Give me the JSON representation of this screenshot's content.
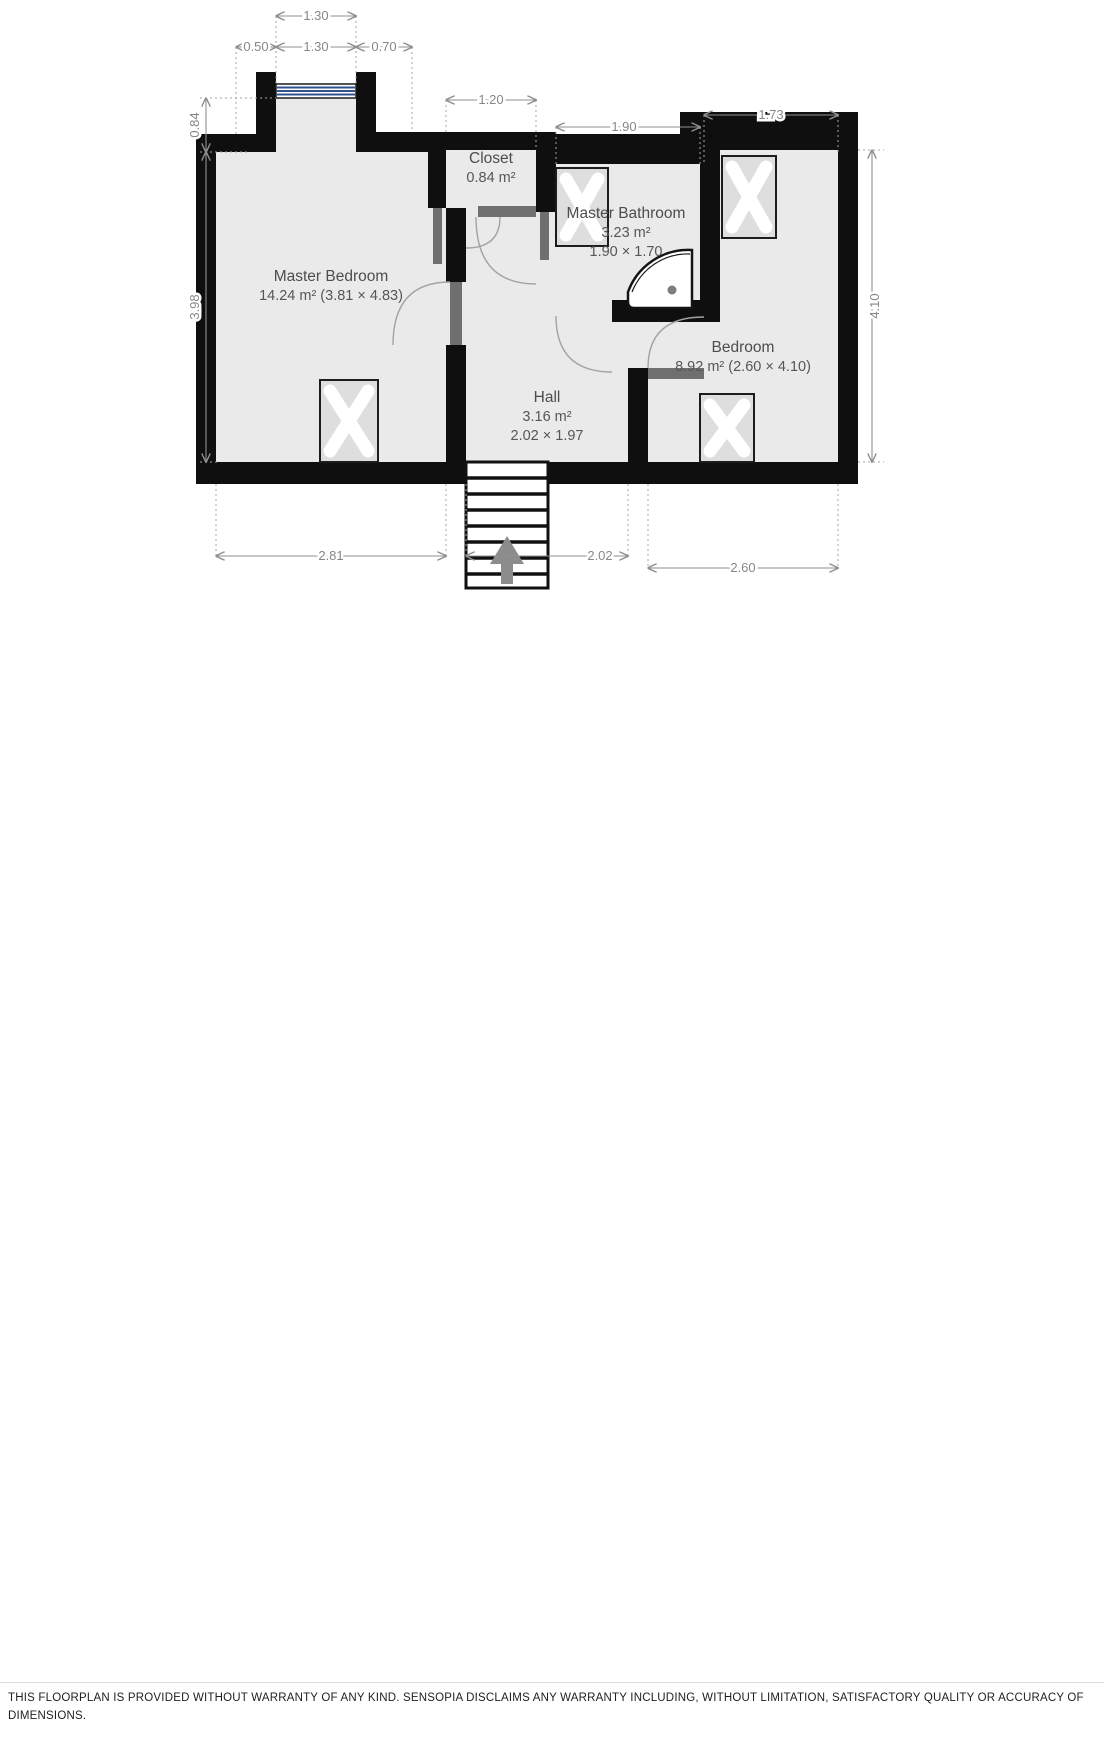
{
  "plan": {
    "rooms": {
      "master_bedroom": {
        "name": "Master Bedroom",
        "area": "14.24 m² (3.81 × 4.83)"
      },
      "closet": {
        "name": "Closet",
        "area": "0.84 m²"
      },
      "master_bathroom": {
        "name": "Master Bathroom",
        "area": "3.23 m²",
        "size": "1.90 × 1.70"
      },
      "hall": {
        "name": "Hall",
        "area": "3.16 m²",
        "size": "2.02 × 1.97"
      },
      "bedroom": {
        "name": "Bedroom",
        "area": "8.92 m² (2.60 × 4.10)"
      }
    },
    "dimensions": {
      "window_width_outer": "1.30",
      "left_of_window": "0.50",
      "window_width": "1.30",
      "right_of_window": "0.70",
      "closet_width": "1.20",
      "bathroom_width": "1.90",
      "bedroom_top_width": "1.73",
      "dormer_depth": "0.84",
      "master_bedroom_height": "3.98",
      "bedroom_height": "4.10",
      "master_bedroom_width": "2.81",
      "hall_width": "2.02",
      "bedroom_width": "2.60"
    },
    "colors": {
      "wall": "#0f0f0f",
      "floor": "#eaeaea",
      "dimension_text": "#878787",
      "room_label": "#4d4d4d",
      "window_glass": "#31508f",
      "door_leaf": "#6f6f6f",
      "stairs_arrow": "#8c8c8c"
    }
  },
  "disclaimer": {
    "text": "THIS FLOORPLAN IS PROVIDED WITHOUT WARRANTY OF ANY KIND. SENSOPIA DISCLAIMS ANY WARRANTY INCLUDING, WITHOUT LIMITATION, SATISFACTORY QUALITY OR ACCURACY OF DIMENSIONS."
  }
}
